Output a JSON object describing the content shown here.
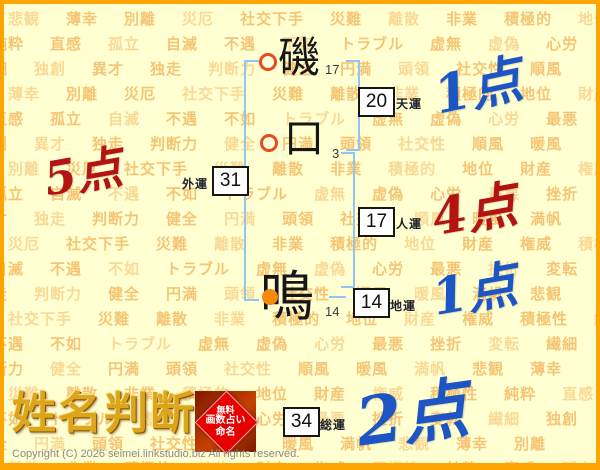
{
  "colors": {
    "background": "#FFFFD2",
    "frame_orange": "#FFA405",
    "watermark_orange": "#F0A33E",
    "bracket_blue": "#8FC7F2",
    "point_blue": "#1D55C4",
    "point_red": "#B31412",
    "circle_ring_red": "#E8491D",
    "circle_fill_orange": "#F58909",
    "logo_gold": "#DCA61C",
    "badge_red": "#E60000"
  },
  "watermark_words": [
    "悲観",
    "薄幸",
    "別離",
    "災厄",
    "社交下手",
    "災難",
    "離散",
    "非業",
    "積極的",
    "地位",
    "財産",
    "権威",
    "積極性",
    "純粋",
    "直感",
    "孤立",
    "自滅",
    "不遇",
    "不如",
    "トラブル",
    "虚無",
    "虚偽",
    "心労",
    "最悪",
    "挫折",
    "変転",
    "繊細",
    "独創",
    "異才",
    "独走",
    "判断力",
    "健全",
    "円満",
    "頭領",
    "社交性",
    "順風",
    "暖風",
    "満帆"
  ],
  "name_chart": {
    "characters": [
      {
        "char": "磯",
        "strokes": "17",
        "marker": "ring"
      },
      {
        "char": "口",
        "strokes": "3",
        "marker": "ring"
      },
      {
        "char": "鳴",
        "strokes": "14",
        "marker": "dot"
      }
    ],
    "fortunes": [
      {
        "label": "天運",
        "value": "20",
        "points": "1点",
        "points_color": "blue"
      },
      {
        "label": "外運",
        "value": "31",
        "points": "5点",
        "points_color": "red"
      },
      {
        "label": "人運",
        "value": "17",
        "points": "4点",
        "points_color": "red"
      },
      {
        "label": "地運",
        "value": "14",
        "points": "1点",
        "points_color": "blue"
      },
      {
        "label": "総運",
        "value": "34",
        "points": "2点",
        "points_color": "blue"
      }
    ]
  },
  "logo": {
    "title": "姓名判断",
    "badge_line1": "無料",
    "badge_line2": "画数占い",
    "badge_line3": "命名"
  },
  "footer": {
    "copyright": "Copyright (C) 2026 seimei.linkstudio.biz All rights reserved."
  }
}
